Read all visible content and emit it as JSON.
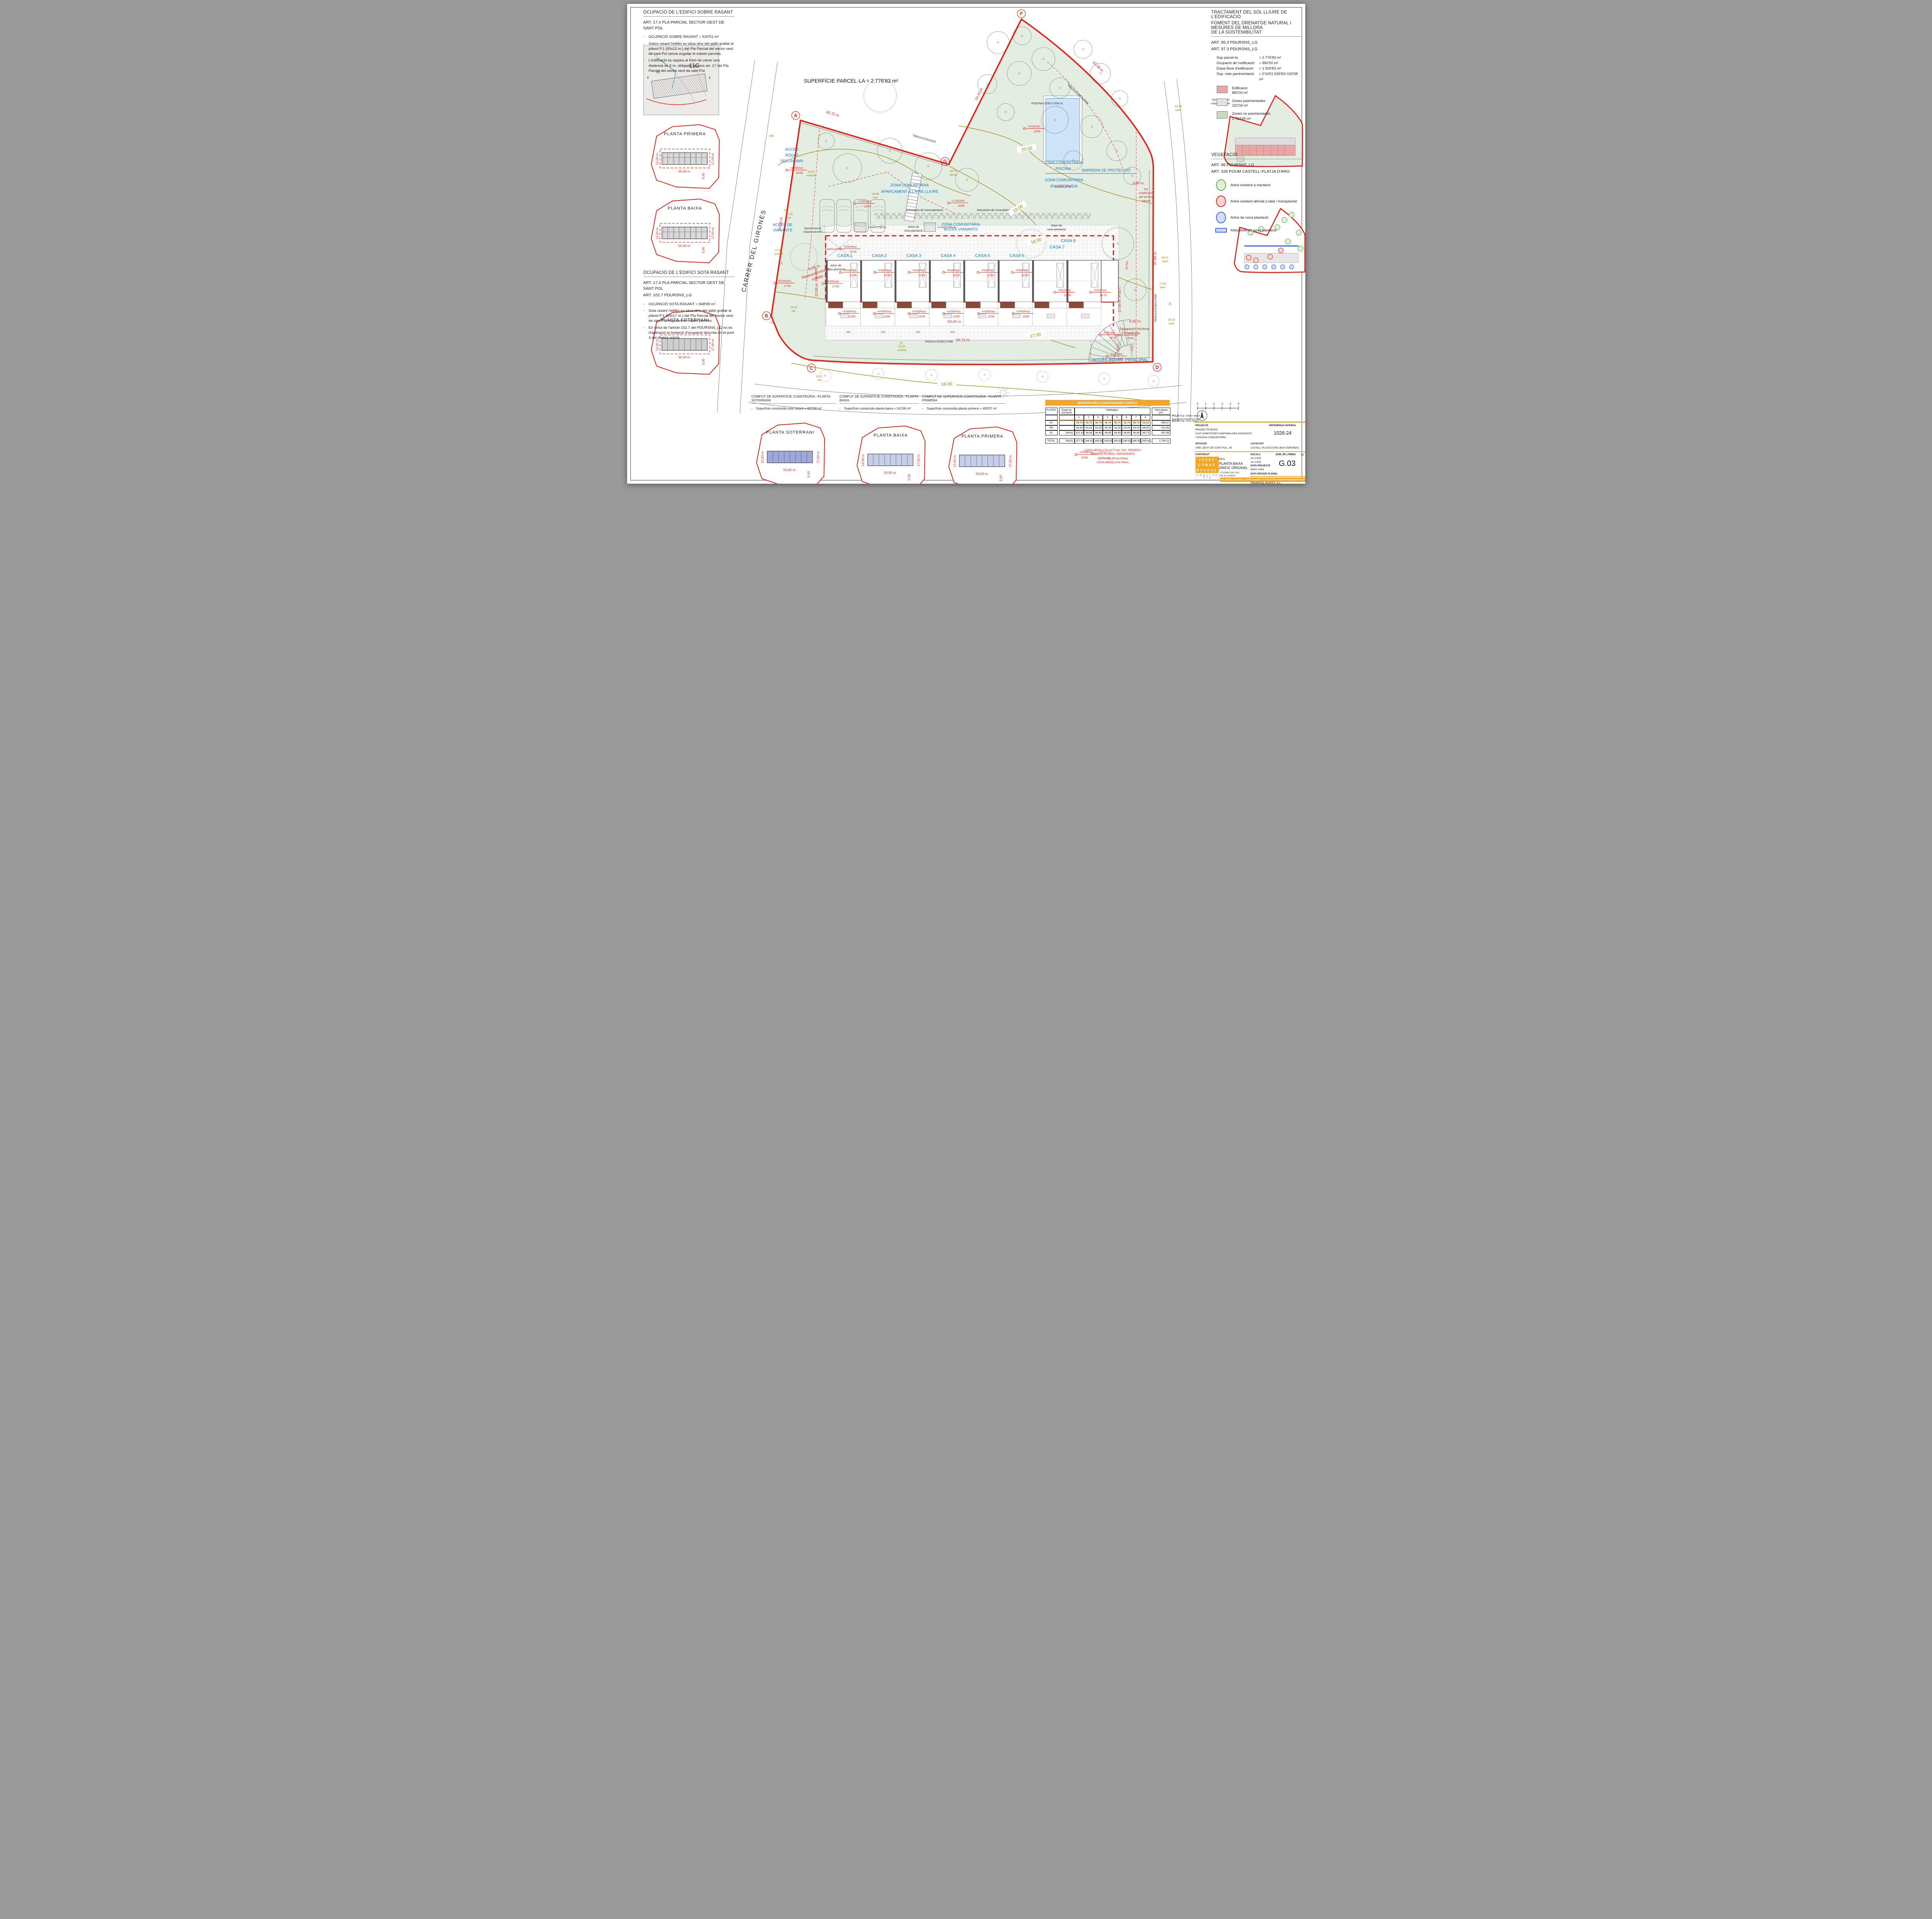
{
  "lt": {
    "title": "OCUPACIÓ DE L'EDIFICI SOBRE RASANT",
    "art": "ART. 17.4 PLA PARCIAL SECTOR OEST DE SANT POL",
    "b1": "OCUPACIÓ SOBRE RASANT = 530'51 m²",
    "b2": "Sobre rasant l'edifici es situa dins del gàlib grafiat al plànol P.1 (50x12 m.) del Pla Parcial del sector oest de sant Pol sense esgotar el màxim permés.",
    "b3": "L'edificació es separa al front de carrer una distància de 5 m. obligada segons art. 17 del Pla Parcial del sector oest de sant Pol."
  },
  "ls": {
    "title": "OCUPACIÓ DE L'EDIFICI SOTA RASANT",
    "a1": "ART. 17.4 PLA PARCIAL SECTOR OEST DE SANT POL",
    "a2": "ART. 102.7 PDURSNS_LG",
    "b1": "OCUPACIÓ SOTA RASANT = 848'98 m²",
    "b2": "Sota rasant l'edifici es situa dins del gàlib grafiat al plànol P.1 (50x17 m.) del Pla Parcial del sector oest de sant Pol esgotant el màxim permés.",
    "b3": "En virtut de l'article 102.7 del PDURSNS_LG no és d'aplicació la limitació d'ocupació descrita en el punt 4 del mateix article."
  },
  "rt": {
    "t1": "TRACTAMENT DEL SÒL LLIURE DE L'EDIFICACIÓ",
    "t2": "FOMENT DEL DRENATGE NATURAL I MESURES DE MILLORA",
    "t3": "DE LA SOSTENIBILITAT",
    "a1": "ART. 95.3 PDURSNS_LG",
    "a2": "ART. 97.3 PDURSNS_LG",
    "rows": [
      {
        "k": "Sup parcel·la",
        "v": "= 2.776'83 m²"
      },
      {
        "k": "Ocupació de l'edificació:",
        "v": "= 850'00 m²"
      },
      {
        "k": "Espai lliure d'edificació:",
        "v": "= 1.926'83 m²"
      },
      {
        "k": "Sup. màx pavimentació",
        "v": "= 0'10X1.926'83=192'68 m²"
      }
    ],
    "leg": [
      {
        "t": "Edificació",
        "v": "850'00 m²",
        "c": "#e7a7a4"
      },
      {
        "t": "Zones pavimentades",
        "v": "192'34 m²",
        "c": "#e3e3e1"
      },
      {
        "t": "Zones no pavimentades",
        "v": "1.734'49 m²",
        "c": "#ccd8c2"
      }
    ]
  },
  "veg": {
    "title": "VEGETACIÓ",
    "a1": "ART. 96 PDURSNS_LG",
    "a2": "ART. 328 POUM CASTELL-PLATJA D'ARO",
    "items": [
      "Arbre existent a mantenir",
      "Arbre existent afectat a talar i transplantar",
      "Arbre de nova plantació",
      "Arbustives de nova plantació"
    ],
    "colors": [
      "#dff0d4|#6aa84f",
      "#f9d5d2|#e02b20",
      "#d6dcf9|#3b6be8",
      "#cdd6f6|#3b6be8"
    ]
  },
  "map": {
    "label": "11C",
    "n50": "50",
    "n8": "8",
    "n6": "6"
  },
  "minis": {
    "primera": "PLANTA PRIMERA",
    "baixa": "PLANTA BAIXA",
    "soterrani": "PLANTA SOTERRANI",
    "d50": "50,00 m.",
    "d12": "12,00 m.",
    "d17": "17,00 m.",
    "d5": "5,00"
  },
  "plan": {
    "parcel_title": "SUPERFÍCIE PARCEL·LA = 2.776'83 m²",
    "houses": [
      "CASA 1",
      "CASA 2",
      "CASA 3",
      "CASA 4",
      "CASA 5",
      "CASA 6",
      "CASA 7",
      "CASA 8"
    ],
    "piscina": "PISCINA 10'50 X 5'50 m.",
    "zona1a": "ZONA COMUNITÀRIA",
    "zona1b": "APARCAMENT A L'AIRE LLIURE",
    "zona2a": "ZONA COMUNITÀRIA",
    "zona2b": "PISCINA",
    "zona3a": "ZONA COMUNITÀRIA",
    "zona3b": "ENJARDINADA",
    "zona4a": "ZONA COMUNITÀRIA",
    "zona4b": "ACCÉS VIANANTS",
    "barrera": "BARRERA DE PROTECCIÓ",
    "acc_sec": [
      "ACCÉS",
      "RODAT",
      "SECUNDARI"
    ],
    "acc_via": [
      "ACCÉS DE",
      "VIANANTS"
    ],
    "acc_ppal": "ACCÉS RODAT PRINCIPAL",
    "street": "CARRER DEL GIRONÈS",
    "tanca_exist": "TANCA EXISTENT",
    "tanca_exec": "TANCA A EXECUTAR",
    "dims": {
      "d2672": "26.72 m.",
      "d2443": "24,43 m.",
      "d9338": "93.38 m.",
      "d3469": "34.69 m.",
      "d5972": "59.72 m.",
      "d5000": "50,00 m.",
      "d3784": "37.84 m.",
      "d1700": "17,00 m. P.SOT.",
      "d1200": "12,00 m. PB+2PP",
      "d600": "6,00 m.",
      "sep1": "Separació mínima",
      "sep2": "a límits",
      "d300": "3,00 m.",
      "nomod": [
        "No",
        "modificació",
        "del terreny",
        "natural"
      ]
    },
    "rampa": "RAMPA 6'80%",
    "talus": "TALÚS 27%",
    "talus_v": "TALÚS",
    "p500": "5'00%",
    "p2": "2%",
    "hmur": "h mur=1'50 m.",
    "arbre_nova": [
      "Arbre de",
      "nova plantació"
    ],
    "arbustives": "Arbustives de nova plantació",
    "diposit": [
      "Dipòsit soterrat",
      "d'aigües pluvials"
    ],
    "levels": {
      "pav": {
        "l": "-0'02(Pav)",
        "v": "16'78"
      },
      "pav0": {
        "l": "+0'00(Pav)",
        "v": "16'80"
      },
      "vor120": {
        "l": "+1'20(Vor)",
        "v": "18'00"
      },
      "jar120": {
        "l": "+1'20(Jar)",
        "v": "18'00"
      },
      "vor020": {
        "l": "+0'20(Vor)",
        "v": "17'00"
      },
      "jar020": {
        "l": "+0'20(Jar)",
        "v": "17'00"
      },
      "jar315": {
        "l": "+3'15(Jar)",
        "v": "19'95"
      },
      "jar030": {
        "l": "-0'30(Jar)",
        "v": "16'50"
      },
      "vor115": {
        "l": "-1'15(Vor)",
        "v": "15'65"
      },
      "vor140": {
        "l": "-1'40(Vor)",
        "v": "15'40"
      }
    },
    "contours": [
      "20.00",
      "19.00",
      "18.00",
      "17.00",
      "16.00"
    ],
    "topo": [
      {
        "v": "d60",
        "t": ""
      },
      {
        "v": "18.25",
        "t": "vorlímit"
      },
      {
        "v": "18.48",
        "t": "mur"
      },
      {
        "v": "18.70",
        "t": "tanca"
      },
      {
        "v": "17.49",
        "t": "vor"
      },
      {
        "v": "17.32",
        "t": "vorlímit"
      },
      {
        "v": "16.43",
        "t": "vor"
      },
      {
        "v": "15.41",
        "t": "vorlímit"
      },
      {
        "v": "15.17",
        "t": "vor"
      },
      {
        "v": "19.17",
        "t": "camí"
      },
      {
        "v": "18.23",
        "t": "camí"
      },
      {
        "v": "20.54",
        "t": "camí"
      },
      {
        "v": "17.40",
        "t": "camí"
      },
      {
        "v": "15.73",
        "t": "camí"
      }
    ],
    "letters": [
      "A",
      "B",
      "C",
      "D",
      "F",
      "G"
    ]
  },
  "cota": {
    "l1": "COTA ABSOLUTA-ACTUAL DEL TERRENY",
    "l2": "SEGONS PLANOL TOPOGRÀFIC",
    "l3": "COTA RELATIVA FINAL",
    "l4": "COTA ABSOLUTA FINAL",
    "ml": "+0'00(Pav)",
    "mv": "16'80"
  },
  "computs": [
    {
      "title": "CÒMPUT DE SUPERFÍCIE CONSTRUÏDA - PLANTA SOTERRANI",
      "line": "Superfície construïda sota rasant = 822'98 m²"
    },
    {
      "title": "CÒMPUT DE SUPERFÍCIE CONSTRUÏDA - PLANTA BAIXA",
      "line": "Superfície construïda planta baixa = 511'66 m²"
    },
    {
      "title": "CÒMPUT DE SUPERFÍCIE CONSTRUÏDA - PLANTA PRIMERA",
      "line": "Superfície construïda planta primera = 459'57 m²"
    }
  ],
  "table": {
    "title": "SUPERFICÍES CONSTRUIDES EDIFICI",
    "col_planta": "PLANTA",
    "col_espai": "Espai de circulació",
    "col_hab": "Habitatges",
    "col_total": "Total planta (m²)",
    "habs": [
      "1",
      "2",
      "3",
      "4",
      "5",
      "6",
      "7",
      "8"
    ],
    "rows": [
      {
        "p": "P1",
        "c": [
          "-",
          "59,75",
          "56,76",
          "56,76",
          "56,76",
          "56,76",
          "56,76",
          "56,76",
          "59,26"
        ],
        "t": "459,57"
      },
      {
        "p": "PB",
        "c": [
          "-",
          "65,93",
          "63,28",
          "63,28",
          "63,28",
          "63,28",
          "63,28",
          "63,28",
          "66,05"
        ],
        "t": "511,66"
      },
      {
        "p": "S1",
        "c": [
          "249,81",
          "102,10",
          "66,89",
          "66,89",
          "66,89",
          "66,89",
          "66,89",
          "66,89",
          "69,73"
        ],
        "t": "822,98"
      }
    ],
    "total": {
      "p": "TOTAL",
      "c": [
        "249,81",
        "227,78",
        "186,93",
        "186,93",
        "186,93",
        "186,93",
        "186,93",
        "186,93",
        "195,04"
      ],
      "t": "1.794,21"
    },
    "note1v": "971,23",
    "note1t": "Sup. Sobre rasant",
    "note2v": "822,98",
    "note2t": "Sup. Sota rasant"
  },
  "tb": {
    "projecte_label": "PROJECTE",
    "p1": "PROJECTE BÀSIC",
    "p2": "VUIT HABITATGES UNIFAMILIARS ADOSSATS",
    "p3": "I PISCINA COMUNITÀRIA",
    "ref_label": "REFERÈNCIA INTERNA",
    "ref": "1026-24",
    "sit_label": "SITUACIÓ",
    "sit": "URB. OEST DE SANT POL, 45",
    "loc_label": "LOCALITAT",
    "loc": "CASTELL-PLATJA D'ARO (BAIX EMPORDÀ)",
    "cont_label": "CONTINGUT",
    "info": "INFORMACIÓ GENERAL",
    "c1": "IMPLANTACIÓ PLANTA BAIXA",
    "c2": "SOBRE TOPOGRÀFIC ORIGINAL",
    "escala_label": "ESCALA",
    "e1": "A0  1/100",
    "e2": "A2  1/200",
    "lam_label": "NÚM. DE LÀMINA",
    "lam_num": "03",
    "data_label": "DATA PROJECTE",
    "data": "MAIG 2024",
    "code": "G.03",
    "rev_label": "DATA REVISIÓ PLÀNOL",
    "prom_label": "PROMOTOR",
    "prom": "PROMITAL INVEST, S.L.",
    "logo1": "JOSEP",
    "logo2": "COMAS",
    "logo3": "BOADAS",
    "logo_sub": "A R Q U I T E C T E",
    "firm1": "COVIARQ 2007 SLP",
    "firm2": "NIF B-17978024",
    "contact": "Col. 32765-4 // C.Lleida, 7 / 17240 Llagostera / T. 972 831 561 / arquitectura@josepcomas.cat"
  },
  "scale": {
    "ticks": [
      "0",
      "1",
      "2",
      "3",
      "4",
      "5"
    ]
  }
}
